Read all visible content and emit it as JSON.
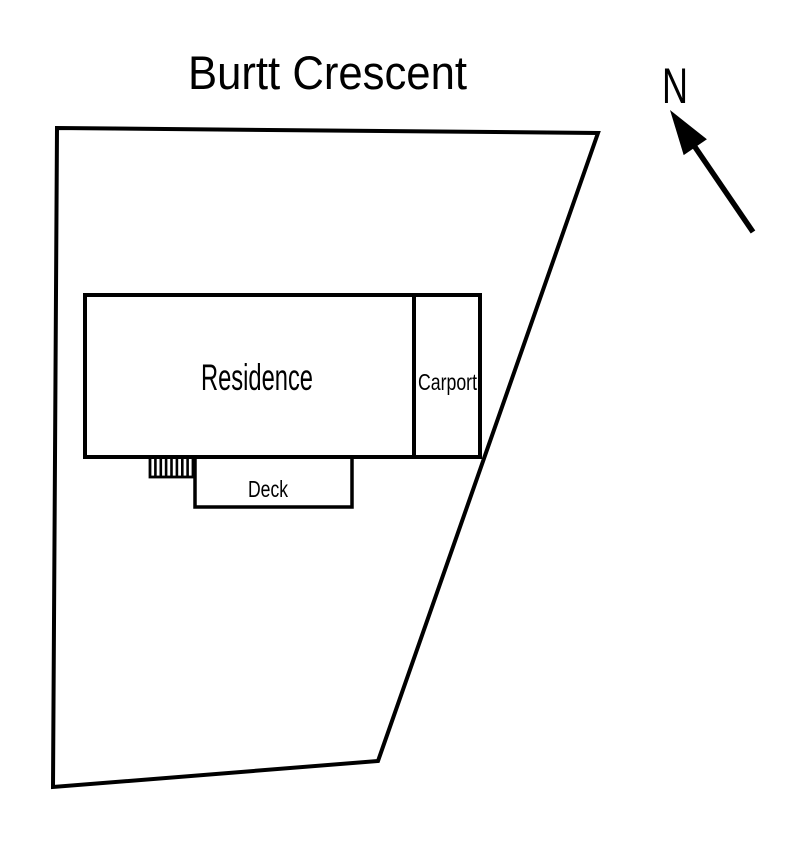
{
  "diagram": {
    "title": "Burtt Crescent",
    "compass": {
      "label": "N"
    },
    "labels": {
      "residence": "Residence",
      "carport": "Carport",
      "deck": "Deck"
    },
    "colors": {
      "line": "#000000",
      "background": "#ffffff",
      "text": "#000000"
    }
  }
}
